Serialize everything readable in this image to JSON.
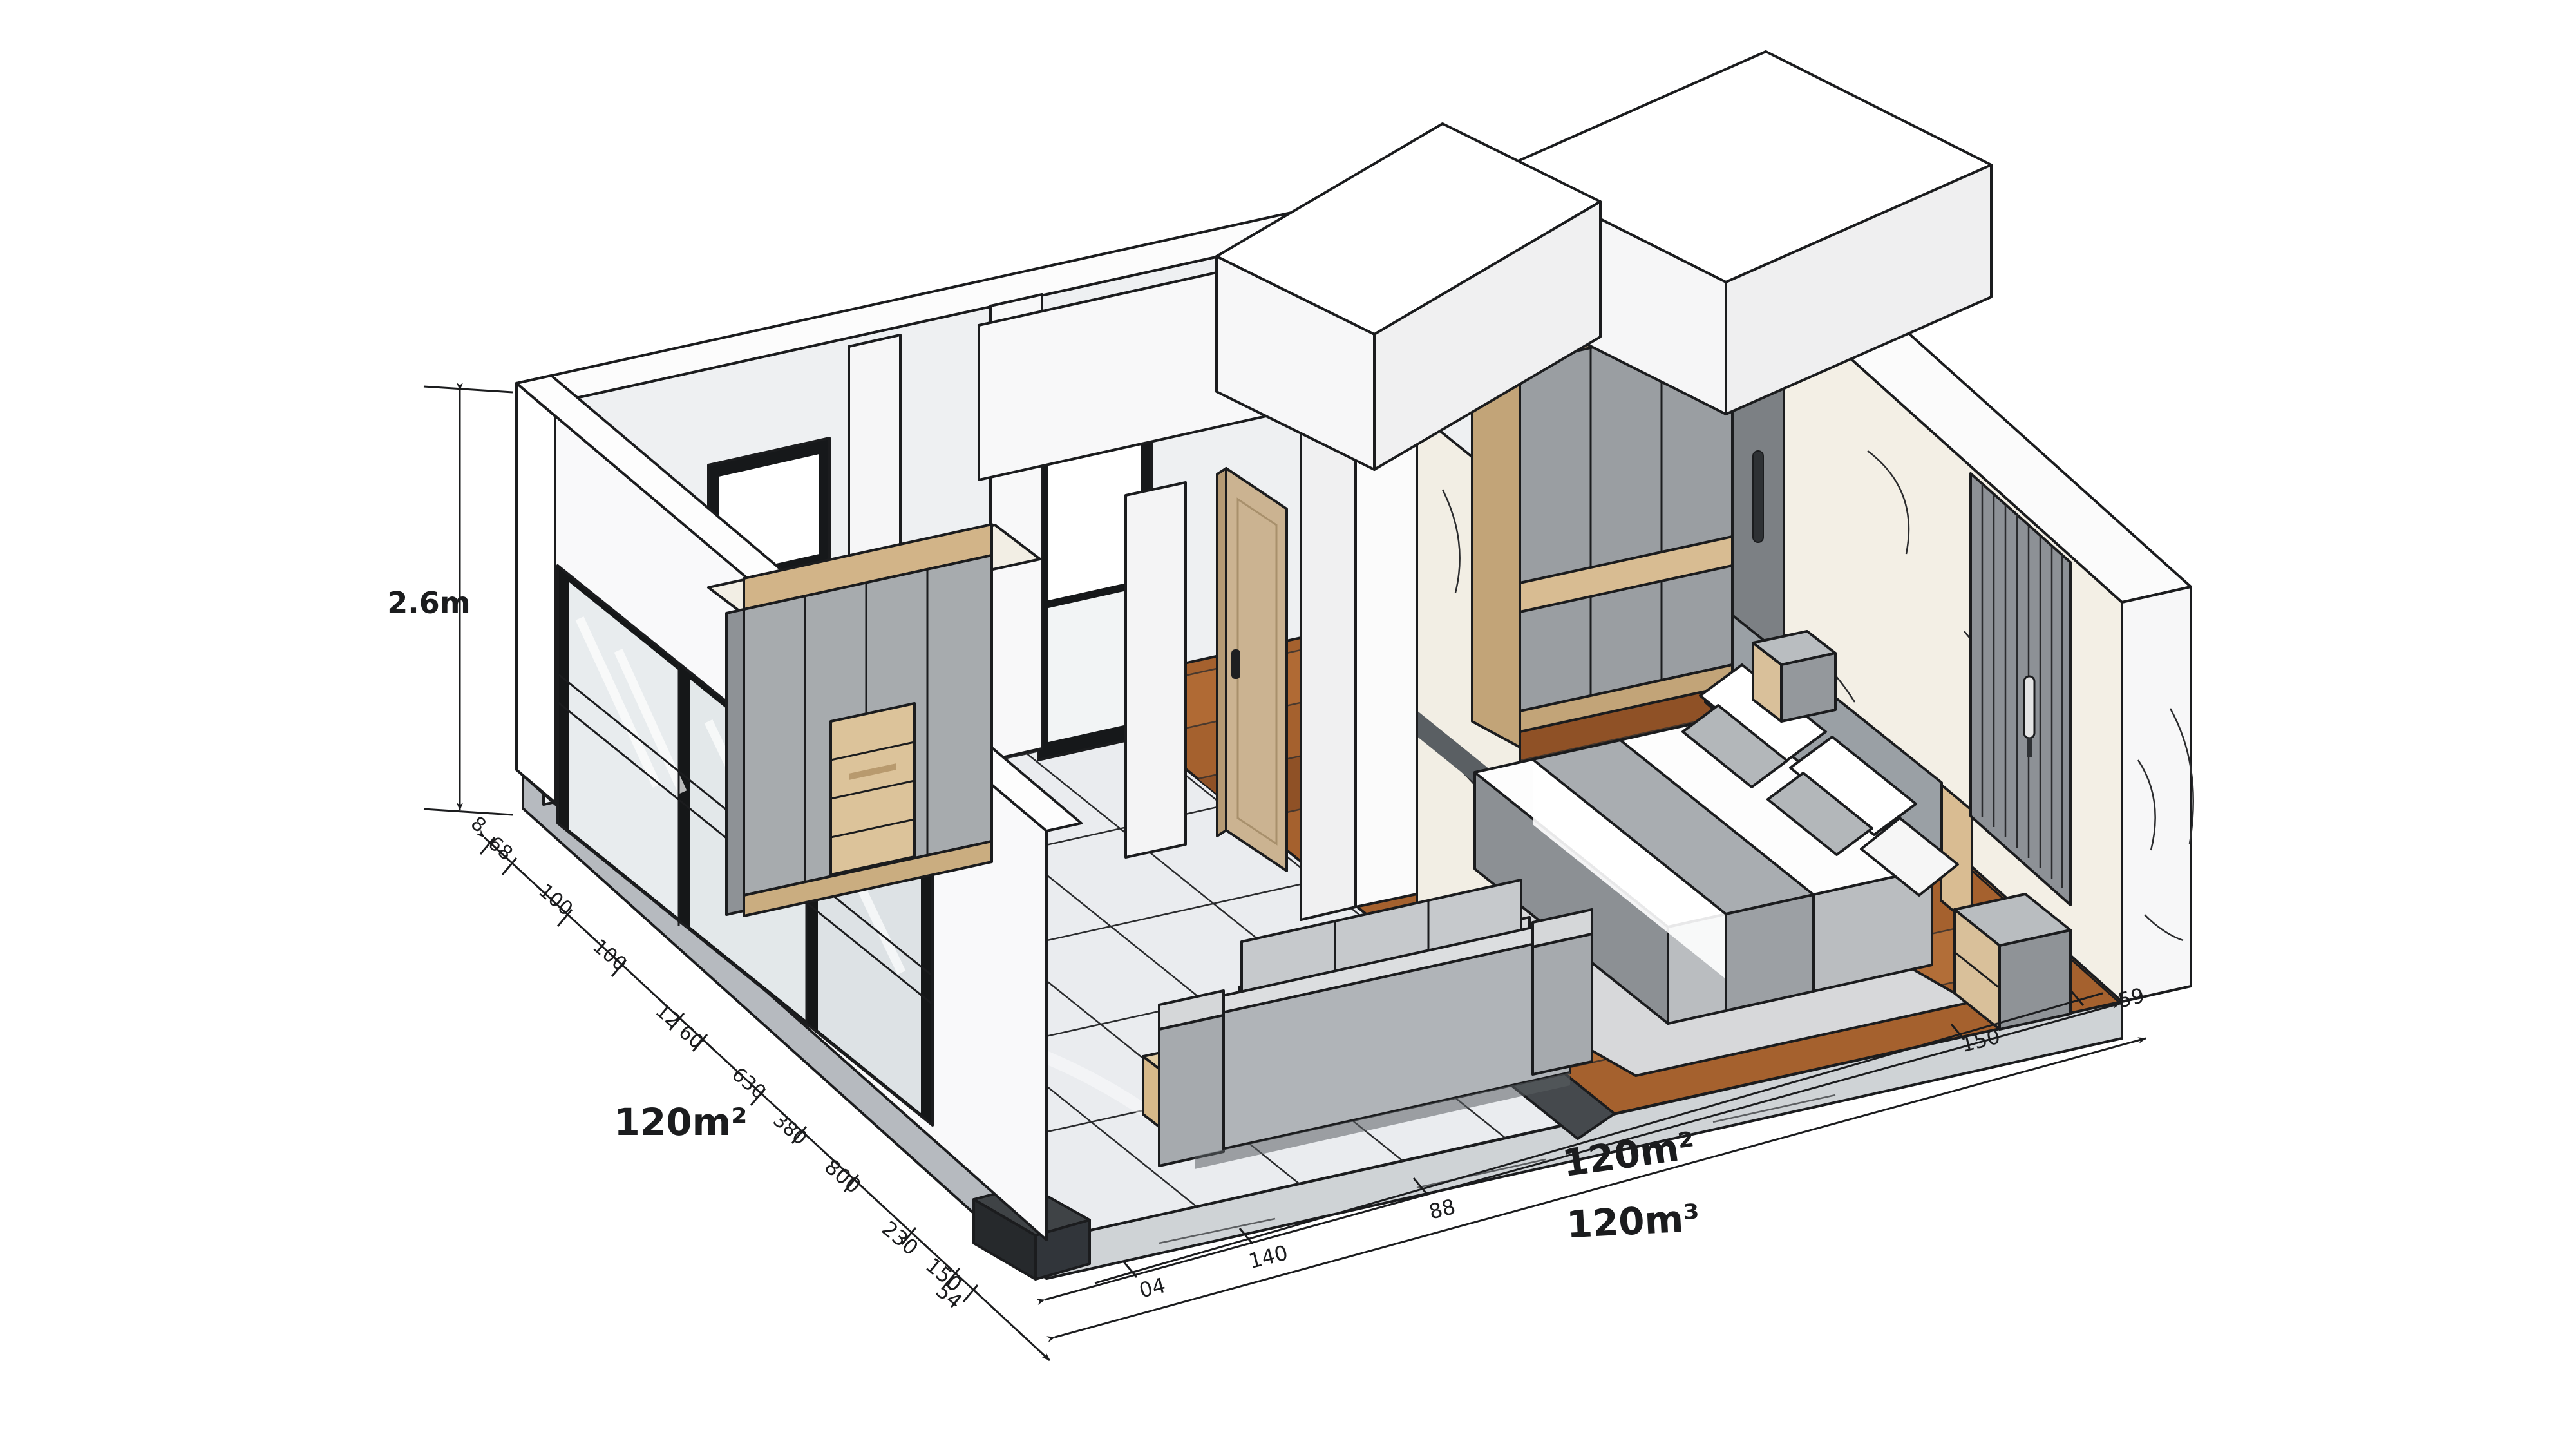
{
  "annotations": {
    "height": "2.6m",
    "area_left": "120m²",
    "area_bottom": "120m²",
    "volume": "120m³",
    "left_chain": [
      "8",
      "68",
      "100",
      "100",
      "12",
      "60",
      "630",
      "380"
    ],
    "left_outer": [
      "800",
      "230",
      "150",
      "54"
    ],
    "bottom_chain": [
      "04",
      "140",
      "88",
      "150",
      "59"
    ]
  },
  "colors": {
    "line": "#1b1c1e",
    "tile_floor": "#eaecef",
    "wood_floor": "#a5612e",
    "tan_wood": "#d2b488",
    "furniture_gray": "#a8acb0",
    "marble": "#f4f0e7",
    "wall_white": "#fafafa"
  }
}
